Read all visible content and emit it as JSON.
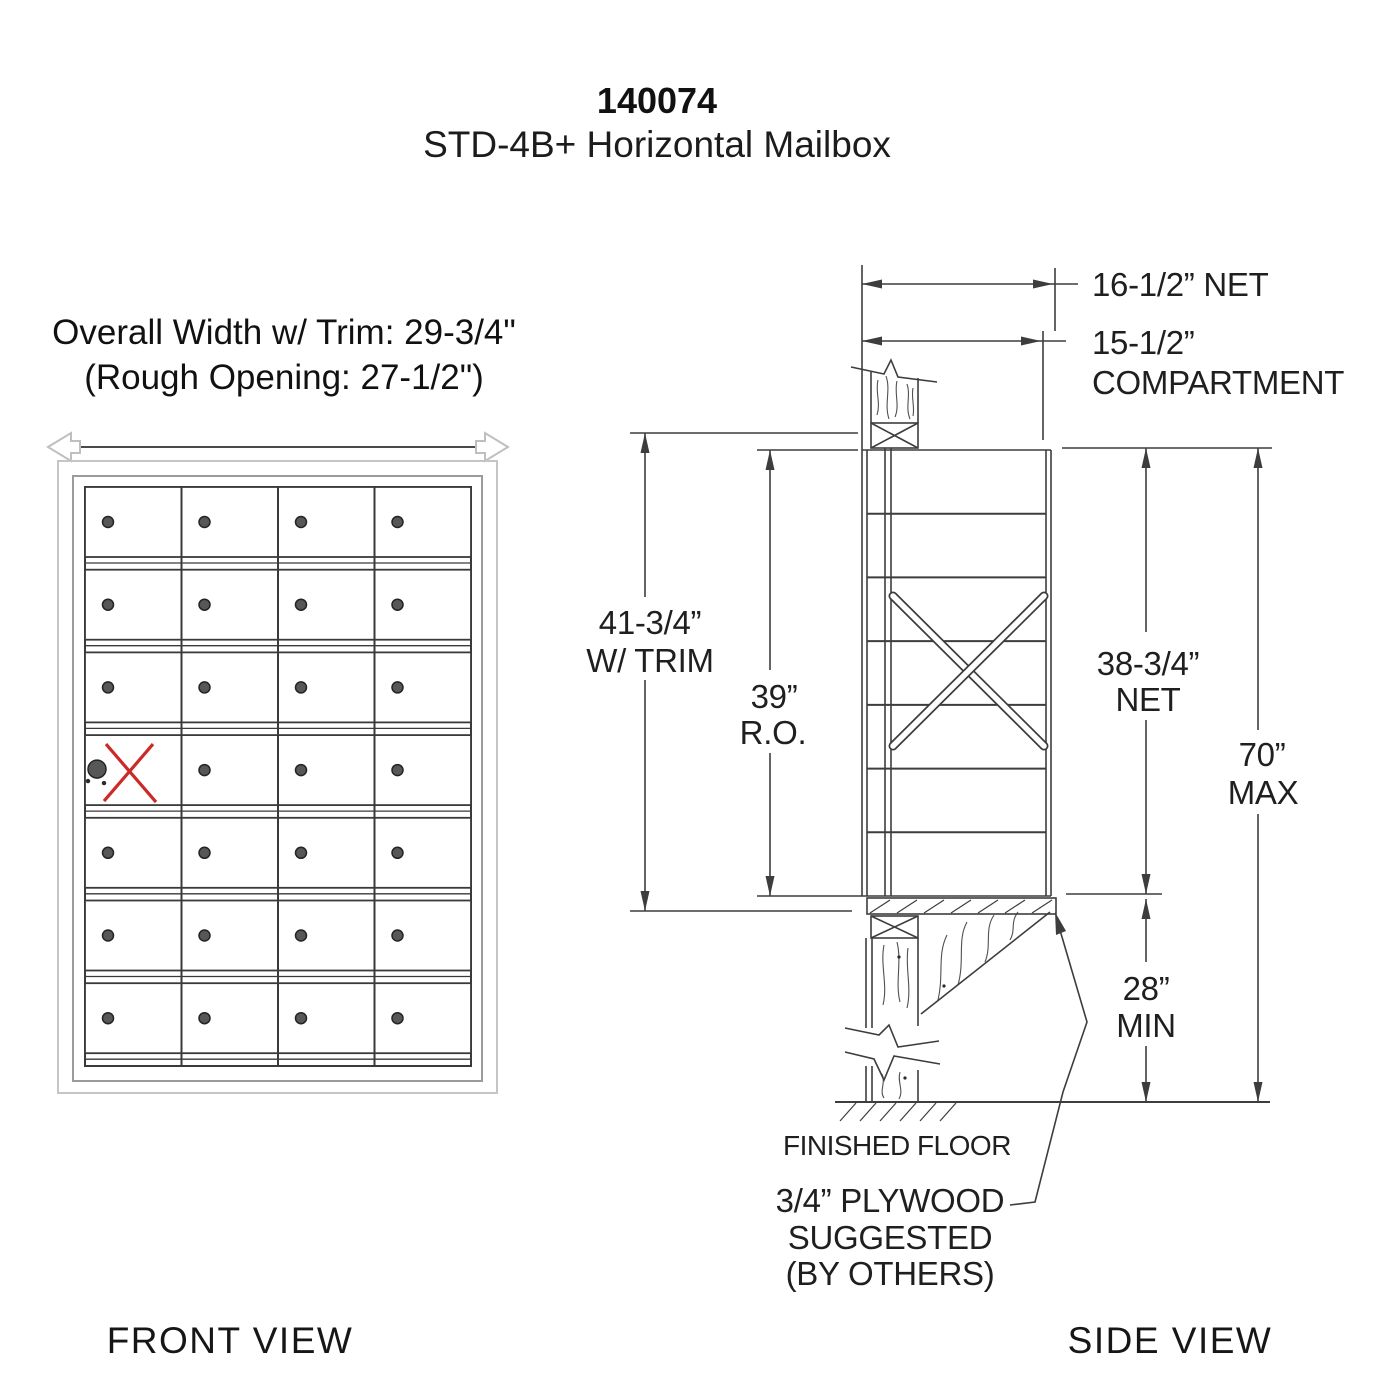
{
  "title": {
    "model": "140074",
    "product": "STD-4B+ Horizontal Mailbox"
  },
  "front_view": {
    "label": "FRONT VIEW",
    "width_note_line1": "Overall Width w/ Trim: 29-3/4\"",
    "width_note_line2": "(Rough Opening: 27-1/2\")",
    "grid": {
      "rows": 7,
      "cols": 4,
      "master_door": {
        "row": 4,
        "col": 1
      }
    }
  },
  "side_view": {
    "label": "SIDE VIEW",
    "dimensions": {
      "net_depth": "16-1/2” NET",
      "compartment_depth_line1": "15-1/2”",
      "compartment_depth_line2": "COMPARTMENT",
      "height_with_trim_line1": "41-3/4”",
      "height_with_trim_line2": "W/ TRIM",
      "rough_opening_line1": "39”",
      "rough_opening_line2": "R.O.",
      "net_height_line1": "38-3/4”",
      "net_height_line2": "NET",
      "max_height_line1": "70”",
      "max_height_line2": "MAX",
      "min_clearance_line1": "28”",
      "min_clearance_line2": "MIN"
    },
    "notes": {
      "floor": "FINISHED FLOOR",
      "plywood_line1": "3/4” PLYWOOD",
      "plywood_line2": "SUGGESTED",
      "plywood_line3": "(BY OTHERS)"
    }
  },
  "colors": {
    "line": "#3d3d3d",
    "red_x": "#cb2a28",
    "frame_light": "#c5c5c5",
    "frame_mid": "#9b9b9b",
    "lock": "#575757"
  }
}
